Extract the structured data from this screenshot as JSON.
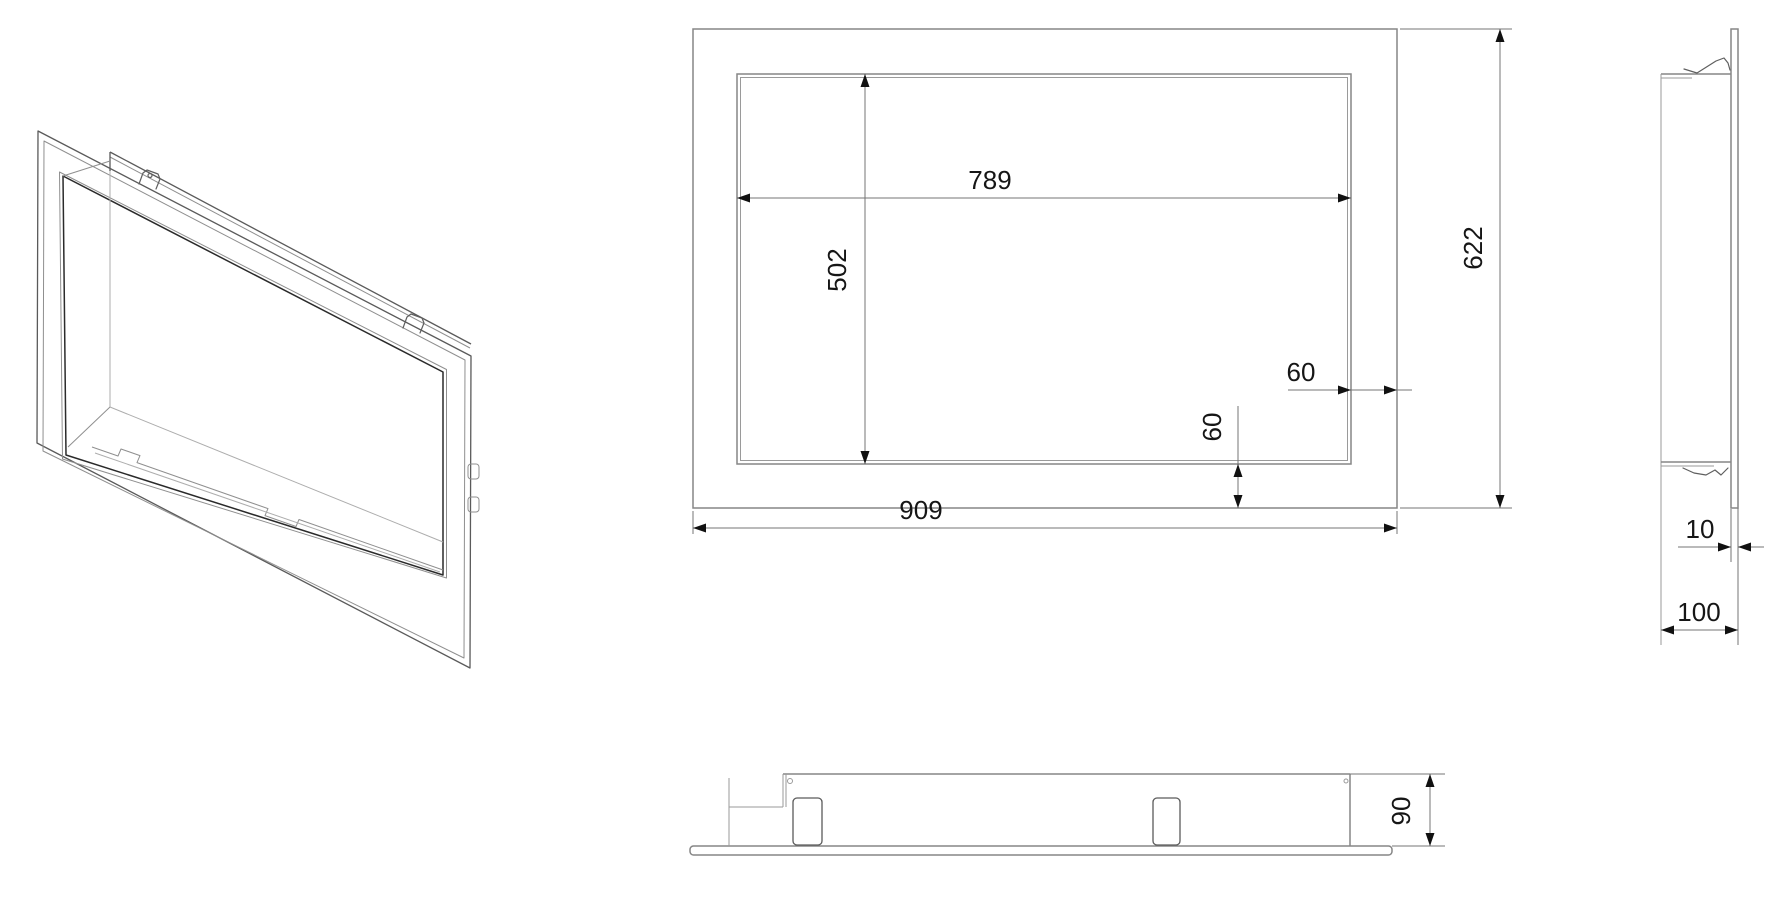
{
  "drawing": {
    "background_color": "#ffffff",
    "line_color": "#868686",
    "dimension_line_color": "#767676",
    "text_color": "#161616",
    "dimensions": {
      "front": {
        "opening_width": "789",
        "opening_height": "502",
        "offset_right": "60",
        "offset_bottom": "60",
        "overall_width": "909",
        "overall_height": "622"
      },
      "side": {
        "plate_thickness": "10",
        "total_depth": "100"
      },
      "bottom": {
        "body_height": "90"
      }
    }
  }
}
